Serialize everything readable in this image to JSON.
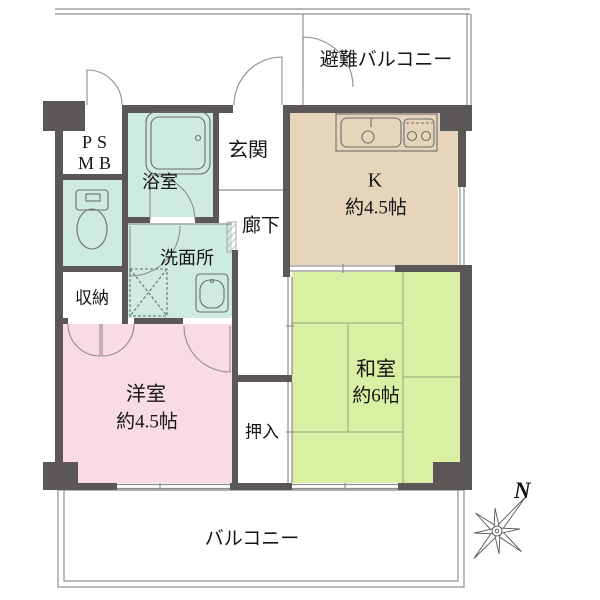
{
  "colors": {
    "wall": "#5a5756",
    "line": "#8e8e8e",
    "icon": "#6e6e6e",
    "tatami": "#98a078",
    "mint": "#cdebdf",
    "pink": "#f9dbe3",
    "green": "#d9efa4",
    "tan": "#e6d5bb",
    "text": "#151515"
  },
  "rooms": {
    "evac_balcony": {
      "label": "避難バルコニー"
    },
    "kitchen": {
      "label": "K",
      "size": "約4.5帖"
    },
    "entrance": {
      "label": "玄関"
    },
    "hallway": {
      "label": "廊下"
    },
    "bathroom": {
      "label": "浴室"
    },
    "pipe_space": {
      "line1": "PS",
      "line2": "MB"
    },
    "washroom": {
      "label": "洗面所"
    },
    "storage": {
      "label": "収納"
    },
    "western_room": {
      "label": "洋室",
      "size": "約4.5帖"
    },
    "japanese_room": {
      "label": "和室",
      "size": "約6帖"
    },
    "closet": {
      "label": "押入"
    },
    "balcony": {
      "label": "バルコニー"
    },
    "compass": {
      "label": "N"
    }
  }
}
